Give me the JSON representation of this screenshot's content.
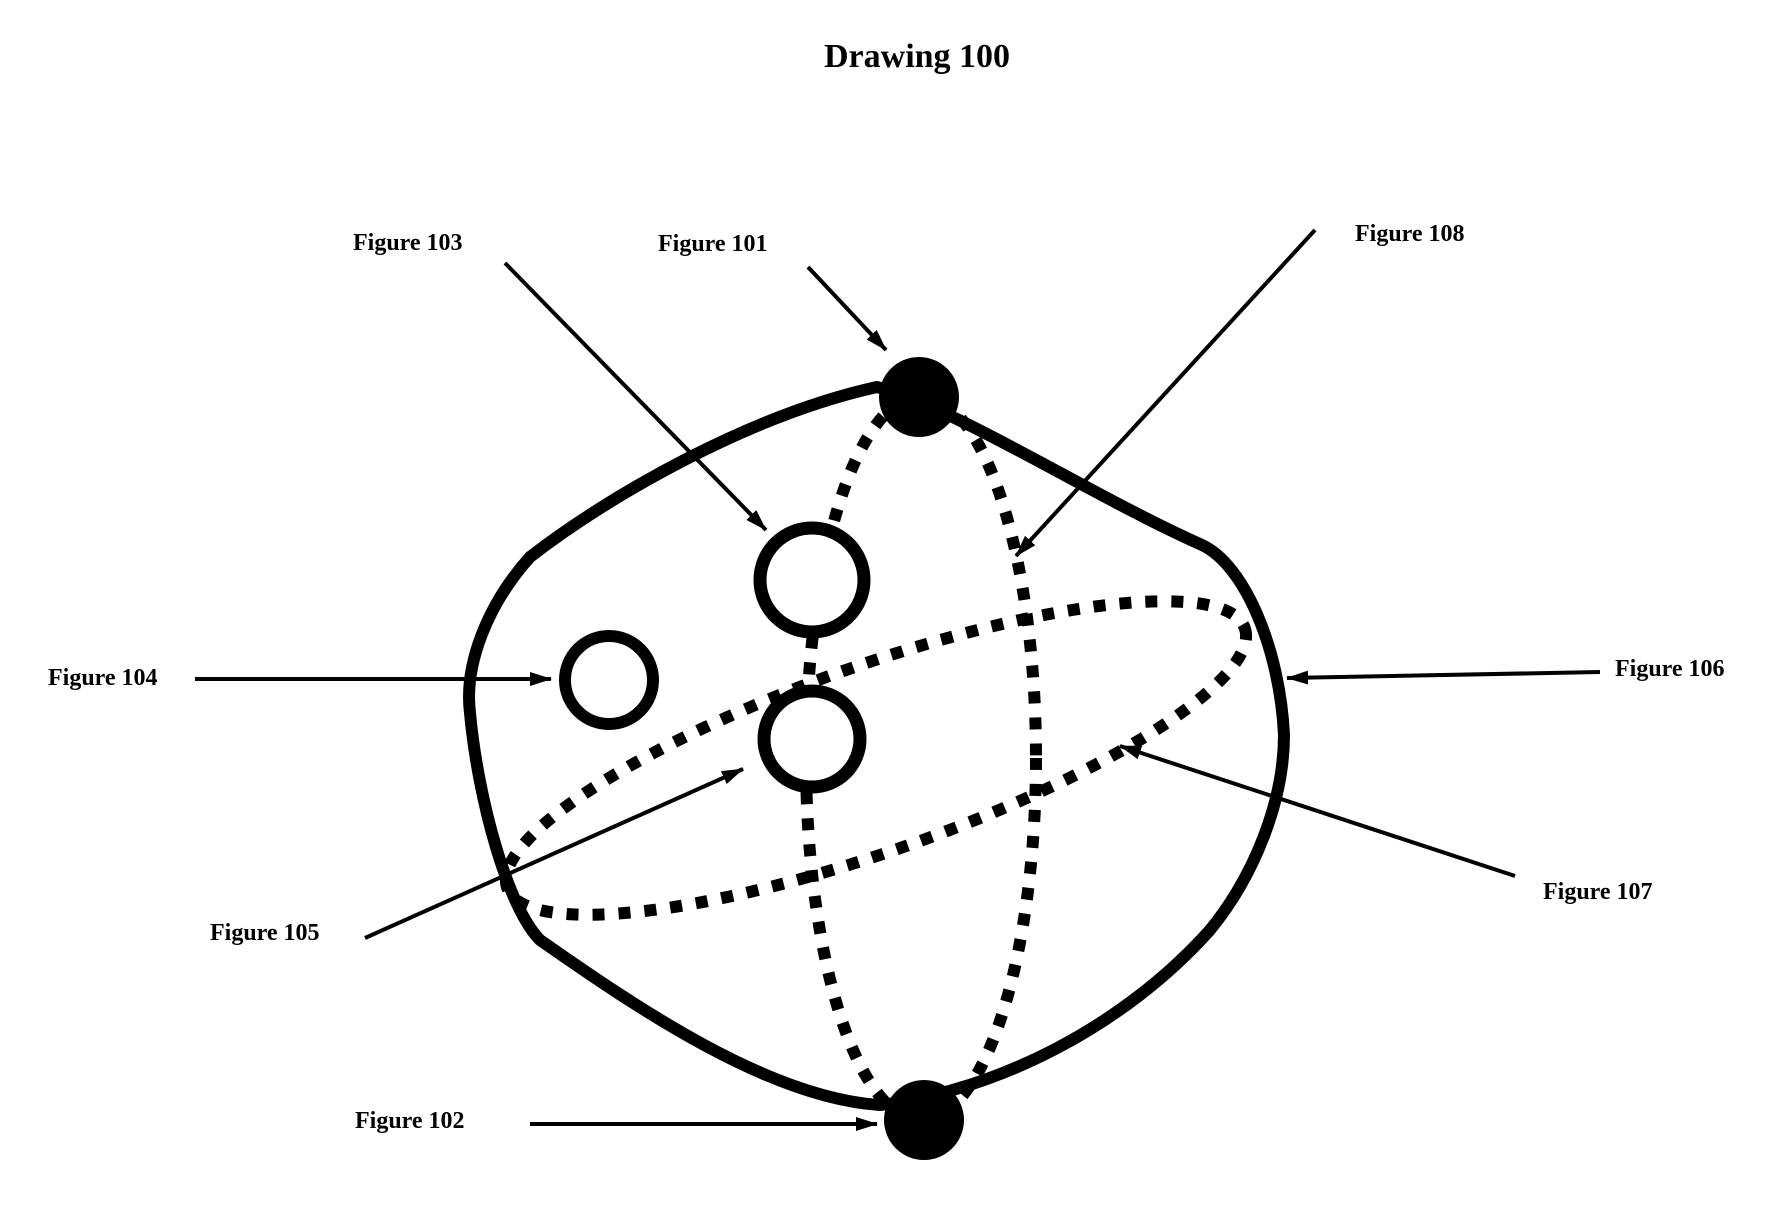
{
  "title": "Drawing 100",
  "labels": {
    "figure101": "Figure 101",
    "figure102": "Figure 102",
    "figure103": "Figure 103",
    "figure104": "Figure 104",
    "figure105": "Figure 105",
    "figure106": "Figure 106",
    "figure107": "Figure 107",
    "figure108": "Figure 108"
  },
  "colors": {
    "ink": "#000000",
    "background": "#ffffff"
  }
}
